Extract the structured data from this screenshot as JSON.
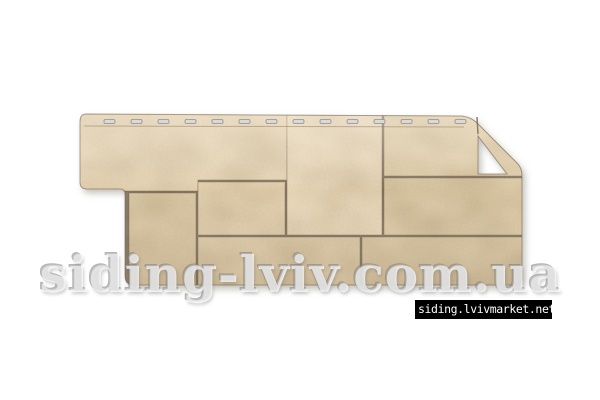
{
  "background": "#ffffff",
  "photo": {
    "x": 50,
    "y": 78,
    "w": 500,
    "h": 240,
    "bg": "#ffffff"
  },
  "watermark": {
    "text": "siding-lviv.com.ua"
  },
  "label": {
    "text": "siding.lvivmarket.net",
    "bg": "#000000",
    "color": "#ffffff"
  },
  "panel": {
    "description": "beige stone-block facade siding panel with top nailing strip, stepped left tab and angled top-right corner with triangular opening",
    "colors": {
      "grout": "#8d7d66",
      "edge_stroke": "rgba(120,104,82,0.6)",
      "stone_stroke": "rgba(101,88,68,0.35)",
      "slot_fill": "#d9d9d9",
      "slot_stroke": "#8f8f8f",
      "hem_line": "rgba(150,130,105,0.55)",
      "shadow": "#8a8578"
    },
    "outline": "M 86,114 L 462,116 Q 471,117 477,123 L 517,163 Q 522,168 522,175 L 522,276 Q 522,285 513,285 L 134,285 Q 125,285 125,276 L 125,194 Q 125,189 120,189 L 87,189 Q 80,189 80,182 L 80,122 Q 80,114 86,114 Z M 478,136 L 478,174 L 507,174 Z",
    "stones": [
      {
        "d": "M 76,112 L 287,112 L 287,180 L 198,180 L 198,191 L 76,191 Z",
        "fill": "#e5d3b3"
      },
      {
        "d": "M 287,113 L 382,113 L 382,235 L 287,235 Z",
        "fill": "#e9d8ba"
      },
      {
        "d": "M 384,113 L 526,113 L 526,176 L 384,176 Z",
        "fill": "#e2cfac"
      },
      {
        "d": "M 384,178 L 526,178 L 526,235 L 384,235 Z",
        "fill": "#dcc9a6"
      },
      {
        "d": "M 129,193 L 196,193 L 196,287 L 129,287 Z",
        "fill": "#ddcaa7"
      },
      {
        "d": "M 198,182 L 285,182 L 285,235 L 198,235 Z",
        "fill": "#e3d0af"
      },
      {
        "d": "M 198,237 L 360,237 L 360,287 L 198,287 Z",
        "fill": "#e0cdab"
      },
      {
        "d": "M 362,237 L 526,237 L 526,287 L 362,287 Z",
        "fill": "#dac7a4"
      }
    ],
    "slots": {
      "count": 14,
      "x0": 104,
      "step": 27,
      "y": 119.5,
      "w": 11,
      "h": 4,
      "rx": 1.5
    },
    "joint_lines": [
      {
        "x1": 477,
        "y1": 117,
        "x2": 478,
        "y2": 134
      }
    ],
    "hem_line": {
      "x1": 84,
      "y1": 126,
      "x2": 464,
      "y2": 127
    }
  }
}
